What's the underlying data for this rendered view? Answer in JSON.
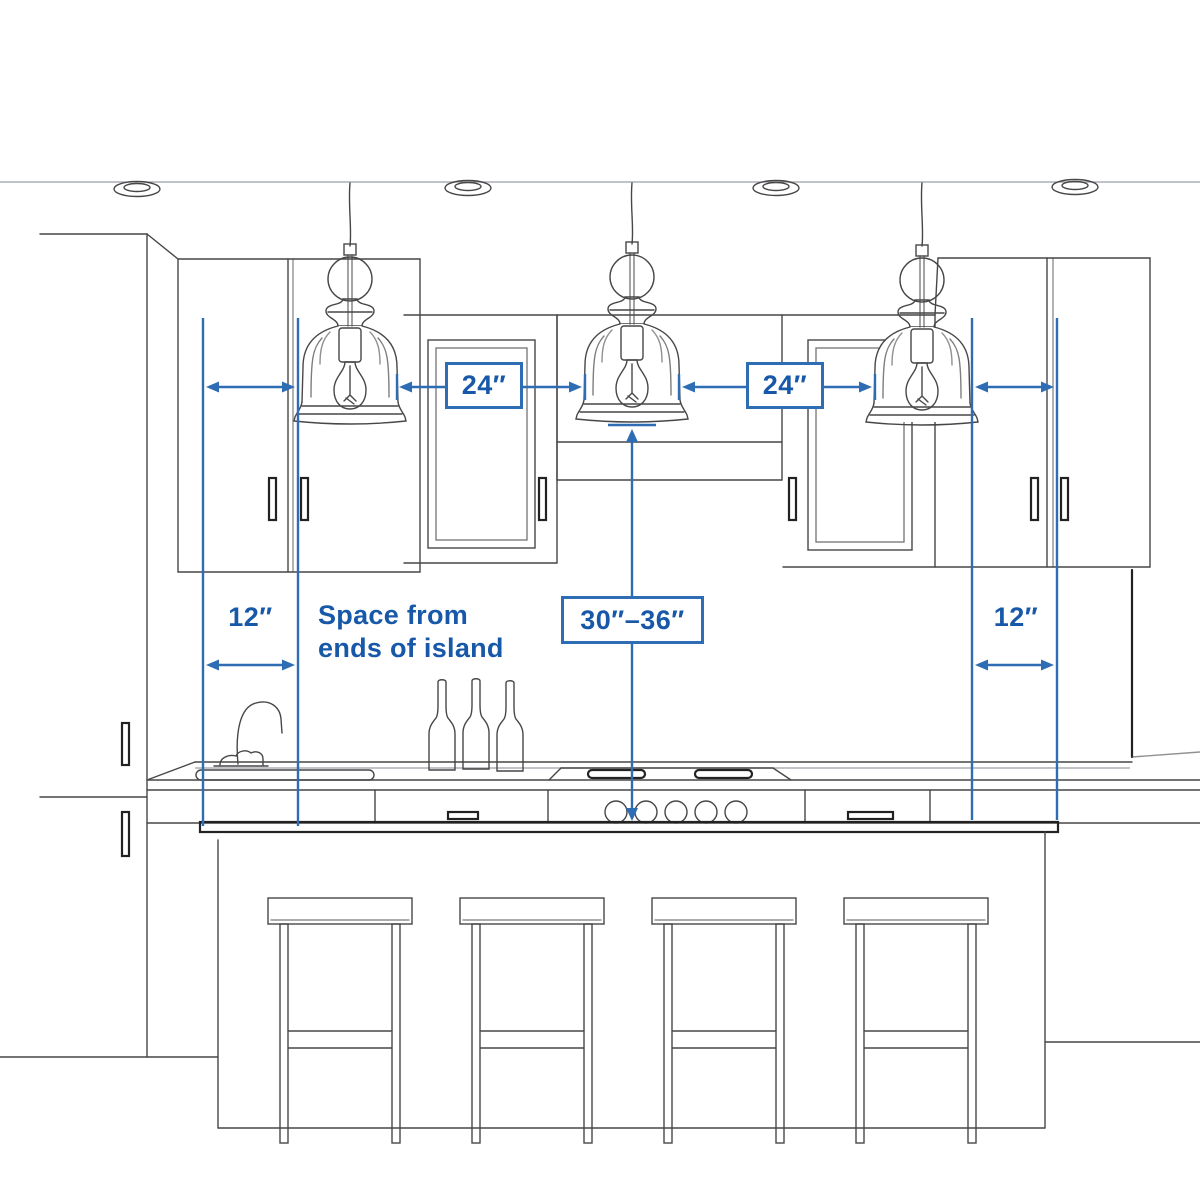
{
  "labels": {
    "pendant_spacing_left": "24″",
    "pendant_spacing_right": "24″",
    "end_clearance_left": "12″",
    "end_clearance_right": "12″",
    "pendant_height_range": "30″–36″",
    "end_clearance_note": "Space from\nends of island"
  },
  "colors": {
    "dimension_line_blue": "#2e6db4",
    "label_text_blue": "#1758a8",
    "sketch_gray": "#4a4a4a"
  },
  "scene": {
    "pendant_lights": 3,
    "recessed_ceiling_lights": 4,
    "bar_stools": 4,
    "wine_bottles": 3,
    "cooktop_knobs": 5
  }
}
